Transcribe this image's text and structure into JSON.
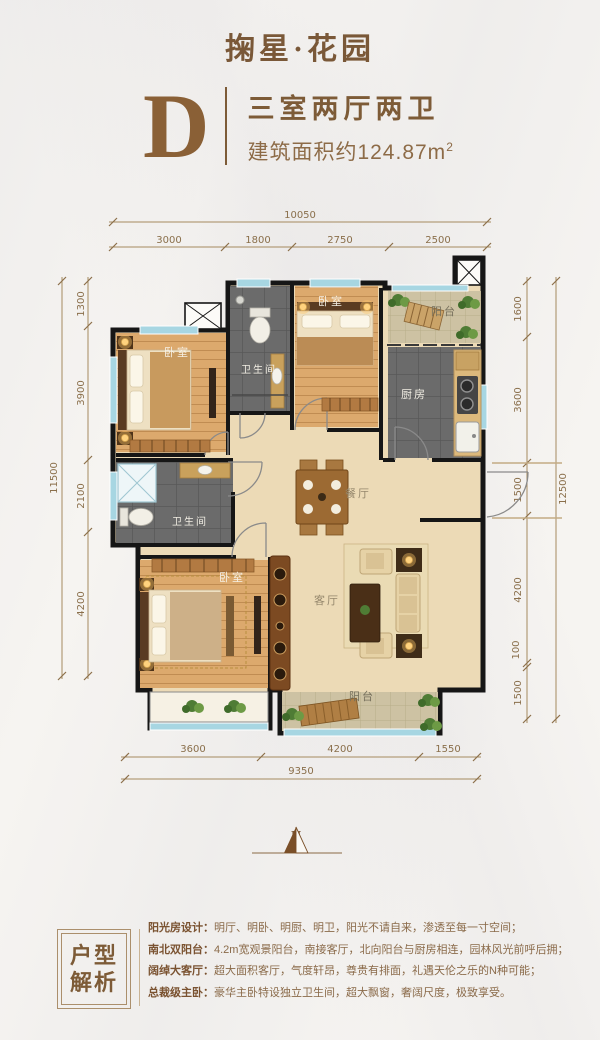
{
  "colors": {
    "accent": "#7d5b37",
    "dim_text": "#8a6f4b",
    "wall": "#161616",
    "wood": "#d9a468",
    "tile_dark": "#6b6b6b",
    "tile_tan": "#cdc2a3",
    "marble": "#ecdab6",
    "window": "#a7d6e2"
  },
  "header": {
    "project_name": "掬星·花园",
    "unit_letter": "D",
    "unit_type": "三室两厅两卫",
    "area_text": "建筑面积约124.87m",
    "area_sup": "2"
  },
  "floorplan": {
    "labels": {
      "bedroom": "卧室",
      "bathroom": "卫生间",
      "kitchen": "厨房",
      "balcony": "阳台",
      "dining": "餐厅",
      "living": "客厅"
    },
    "dims": {
      "top": {
        "total": "10050",
        "segments": [
          "3000",
          "1800",
          "2750",
          "2500"
        ]
      },
      "bottom": {
        "total": "9350",
        "segments": [
          "3600",
          "4200",
          "1550"
        ]
      },
      "left": {
        "total": "11500",
        "segments": [
          "1300",
          "3900",
          "2100",
          "4200"
        ]
      },
      "right": {
        "total": "12500",
        "segments": [
          "1600",
          "3600",
          "1500",
          "4200",
          "100",
          "1500"
        ]
      }
    }
  },
  "compass": {
    "north_label": "N"
  },
  "analysis": {
    "box_title": [
      "户型",
      "解析"
    ],
    "items": [
      {
        "label": "阳光房设计：",
        "text": "明厅、明卧、明厨、明卫，阳光不请自来，渗透至每一寸空间；"
      },
      {
        "label": "南北双阳台：",
        "text": "4.2m宽观景阳台，南接客厅，北向阳台与厨房相连，园林风光前呼后拥；"
      },
      {
        "label": "阔绰大客厅：",
        "text": "超大面积客厅，气度轩昂，尊贵有排面，礼遇天伦之乐的N种可能；"
      },
      {
        "label": "总裁级主卧：",
        "text": "豪华主卧特设独立卫生间，超大飘窗，奢阔尺度，极致享受。"
      }
    ]
  }
}
